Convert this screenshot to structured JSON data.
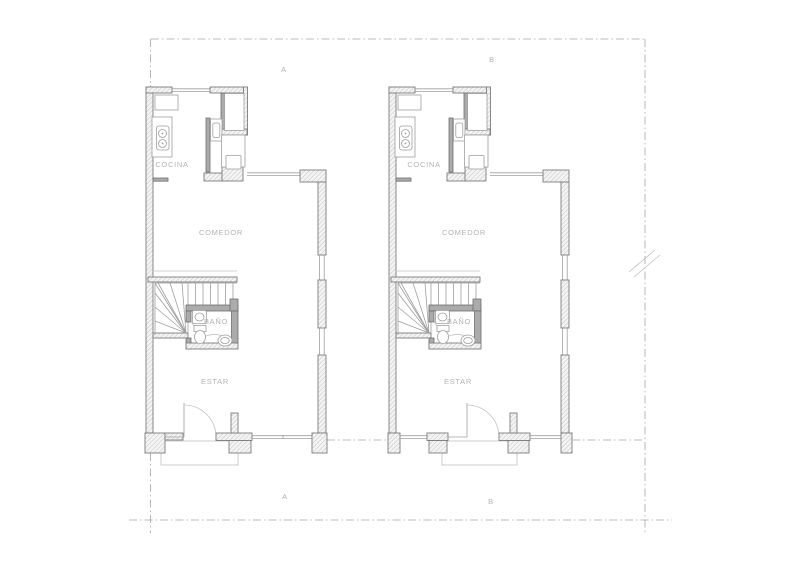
{
  "plan": {
    "type": "architectural-floor-plan",
    "units": [
      {
        "grid_label_top": "A",
        "grid_label_bottom": "A",
        "rooms": {
          "kitchen": "COCINA",
          "dining": "COMEDOR",
          "bathroom": "BAÑO",
          "living": "ESTAR"
        }
      },
      {
        "grid_label_top": "B",
        "grid_label_bottom": "B",
        "rooms": {
          "kitchen": "COCINA",
          "dining": "COMEDOR",
          "bathroom": "BAÑO",
          "living": "ESTAR"
        }
      }
    ],
    "colors": {
      "background": "#ffffff",
      "wall_outline": "#7c7c7c",
      "wall_hatch": "#bcbcbc",
      "partition_fill": "#ababab",
      "thin_line": "#9f9f9f",
      "light_line": "#c2c2c2",
      "label_text": "#b3b3b3",
      "boundary_dash": "#a6a6a6"
    }
  }
}
